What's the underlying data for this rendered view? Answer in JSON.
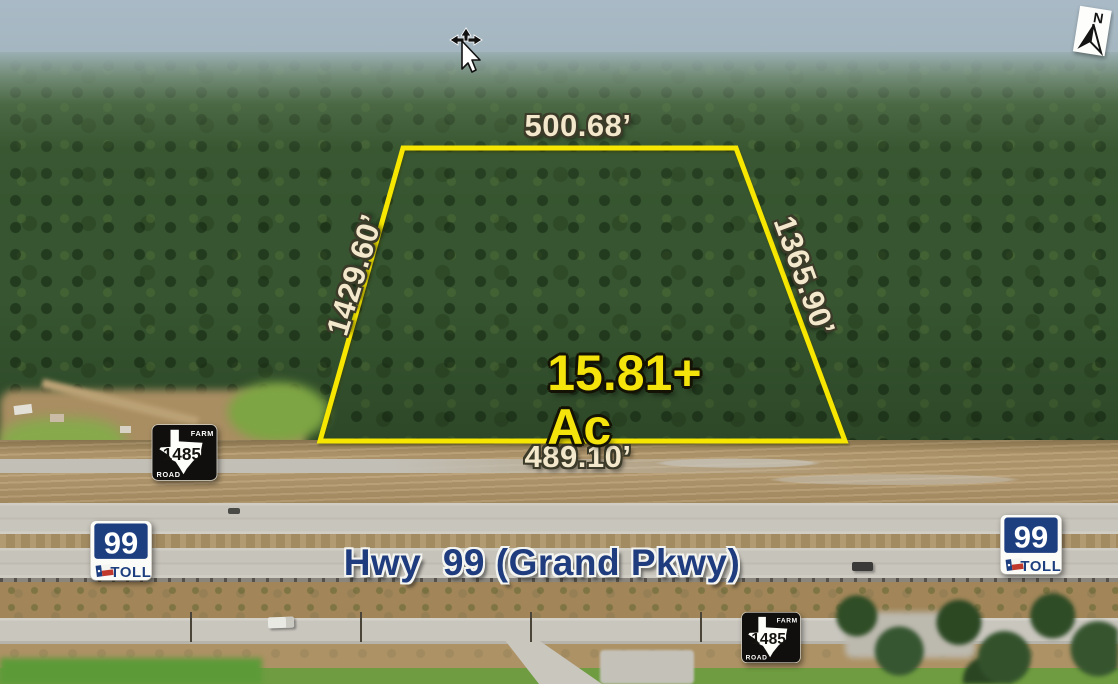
{
  "annotations": {
    "area": {
      "line1": "15.81+",
      "line2": "Ac"
    },
    "dimensions": {
      "top": "500.68’",
      "left": "1429.60’",
      "right": "1365.90’",
      "bottom": "489.10’"
    },
    "highway_label": "Hwy  99 (Grand Pkwy)"
  },
  "shields": {
    "farm_road": {
      "top_text": "FARM",
      "number": "1485",
      "bottom_text": "ROAD"
    },
    "toll": {
      "number": "99",
      "text": "TOLL"
    }
  },
  "compass": {
    "north": "N"
  },
  "colors": {
    "parcel_boundary": "#F6E600",
    "area_text": "#F4E40C",
    "dimension_text": "#F3E8CC",
    "highway_text": "#1E3C7E"
  }
}
